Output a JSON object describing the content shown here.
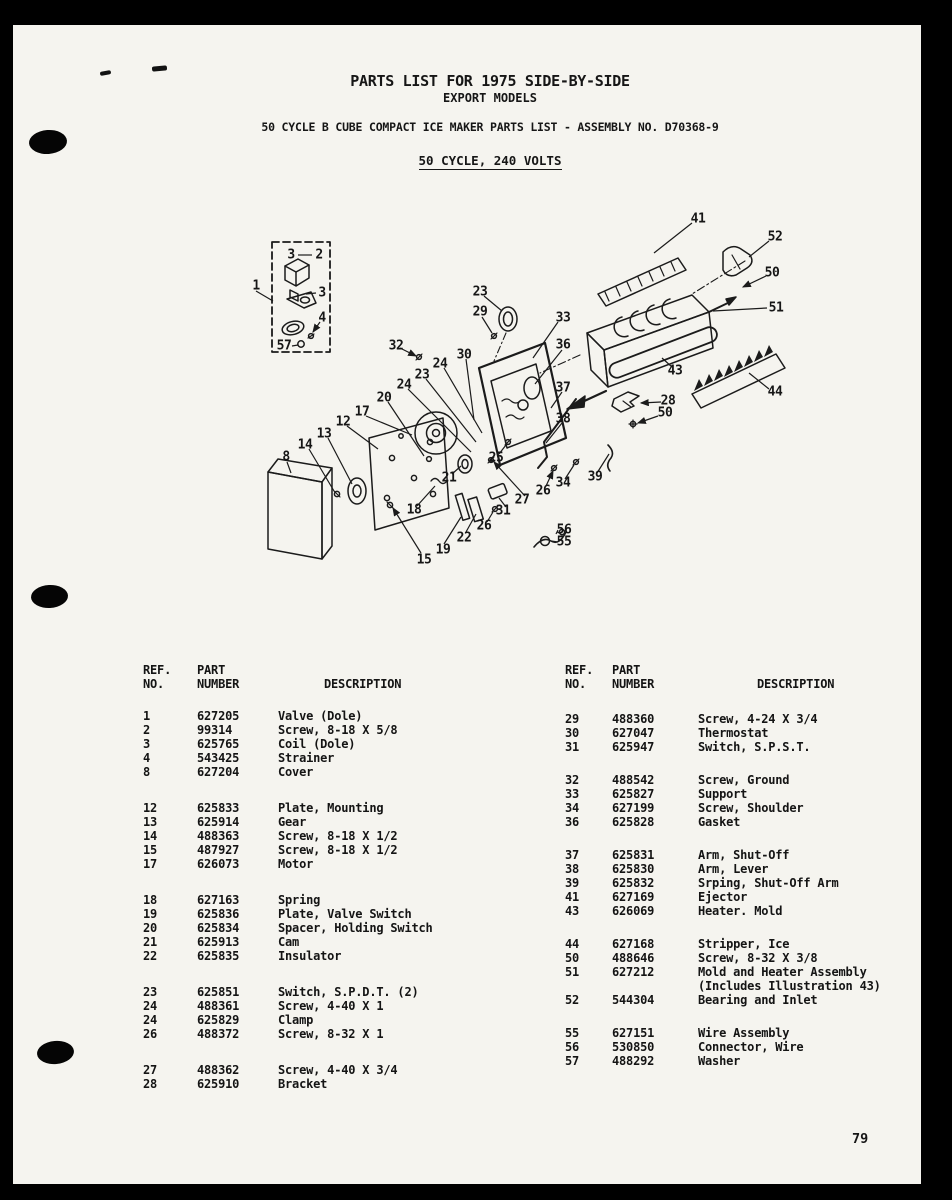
{
  "page": {
    "title_line1": "PARTS LIST FOR 1975 SIDE-BY-SIDE",
    "title_line2": "EXPORT MODELS",
    "subtitle": "50 CYCLE B CUBE COMPACT ICE MAKER PARTS LIST - ASSEMBLY NO. D70368-9",
    "voltage_line": "50 CYCLE, 240 VOLTS",
    "page_number": "79"
  },
  "colors": {
    "paper": "#f5f4ef",
    "ink": "#161616",
    "border": "#000000"
  },
  "parts_tables": {
    "headers": {
      "ref": "REF.",
      "no": "NO.",
      "part": "PART",
      "number": "NUMBER",
      "description": "DESCRIPTION"
    },
    "left": {
      "groups": [
        [
          [
            "1",
            "627205",
            "Valve (Dole)"
          ],
          [
            "2",
            "99314",
            "Screw, 8-18 X 5/8"
          ],
          [
            "3",
            "625765",
            "Coil (Dole)"
          ],
          [
            "4",
            "543425",
            "Strainer"
          ],
          [
            "8",
            "627204",
            "Cover"
          ]
        ],
        [
          [
            "12",
            "625833",
            "Plate, Mounting"
          ],
          [
            "13",
            "625914",
            "Gear"
          ],
          [
            "14",
            "488363",
            "Screw, 8-18 X 1/2"
          ],
          [
            "15",
            "487927",
            "Screw, 8-18 X 1/2"
          ],
          [
            "17",
            "626073",
            "Motor"
          ]
        ],
        [
          [
            "18",
            "627163",
            "Spring"
          ],
          [
            "19",
            "625836",
            "Plate, Valve Switch"
          ],
          [
            "20",
            "625834",
            "Spacer, Holding Switch"
          ],
          [
            "21",
            "625913",
            "Cam"
          ],
          [
            "22",
            "625835",
            "Insulator"
          ]
        ],
        [
          [
            "23",
            "625851",
            "Switch, S.P.D.T. (2)"
          ],
          [
            "24",
            "488361",
            "Screw, 4-40 X 1"
          ],
          [
            "24",
            "625829",
            "Clamp"
          ],
          [
            "26",
            "488372",
            "Screw, 8-32 X 1"
          ]
        ],
        [
          [
            "27",
            "488362",
            "Screw, 4-40 X 3/4"
          ],
          [
            "28",
            "625910",
            "Bracket"
          ]
        ]
      ]
    },
    "right": {
      "groups": [
        [
          [
            "29",
            "488360",
            "Screw, 4-24 X 3/4"
          ],
          [
            "30",
            "627047",
            "Thermostat"
          ],
          [
            "31",
            "625947",
            "Switch, S.P.S.T."
          ]
        ],
        [
          [
            "32",
            "488542",
            "Screw, Ground"
          ],
          [
            "33",
            "625827",
            "Support"
          ],
          [
            "34",
            "627199",
            "Screw, Shoulder"
          ],
          [
            "36",
            "625828",
            "Gasket"
          ]
        ],
        [
          [
            "37",
            "625831",
            "Arm, Shut-Off"
          ],
          [
            "38",
            "625830",
            "Arm, Lever"
          ],
          [
            "39",
            "625832",
            "Srping, Shut-Off Arm"
          ],
          [
            "41",
            "627169",
            "Ejector"
          ],
          [
            "43",
            "626069",
            "Heater. Mold"
          ]
        ],
        [
          [
            "44",
            "627168",
            "Stripper, Ice"
          ],
          [
            "50",
            "488646",
            "Screw, 8-32 X 3/8"
          ],
          [
            "51",
            "627212",
            "Mold and Heater Assembly",
            "(Includes Illustration 43)"
          ],
          [
            "52",
            "544304",
            "Bearing and Inlet"
          ]
        ],
        [
          [
            "55",
            "627151",
            "Wire Assembly"
          ],
          [
            "56",
            "530850",
            "Connector, Wire"
          ],
          [
            "57",
            "488292",
            "Washer"
          ]
        ]
      ]
    }
  },
  "diagram": {
    "callouts": [
      {
        "n": "1",
        "x": 16,
        "y": 91
      },
      {
        "n": "3",
        "x": 51,
        "y": 60
      },
      {
        "n": "2",
        "x": 79,
        "y": 60
      },
      {
        "n": "3",
        "x": 82,
        "y": 98
      },
      {
        "n": "4",
        "x": 82,
        "y": 123
      },
      {
        "n": "57",
        "x": 44,
        "y": 151
      },
      {
        "n": "8",
        "x": 46,
        "y": 262
      },
      {
        "n": "12",
        "x": 103,
        "y": 227
      },
      {
        "n": "13",
        "x": 84,
        "y": 239
      },
      {
        "n": "14",
        "x": 65,
        "y": 250
      },
      {
        "n": "15",
        "x": 184,
        "y": 365
      },
      {
        "n": "17",
        "x": 122,
        "y": 217
      },
      {
        "n": "18",
        "x": 174,
        "y": 315
      },
      {
        "n": "19",
        "x": 203,
        "y": 355
      },
      {
        "n": "20",
        "x": 144,
        "y": 203
      },
      {
        "n": "21",
        "x": 209,
        "y": 283
      },
      {
        "n": "22",
        "x": 224,
        "y": 343
      },
      {
        "n": "23",
        "x": 240,
        "y": 97
      },
      {
        "n": "23",
        "x": 182,
        "y": 180
      },
      {
        "n": "24",
        "x": 200,
        "y": 169
      },
      {
        "n": "24",
        "x": 164,
        "y": 190
      },
      {
        "n": "25",
        "x": 256,
        "y": 263
      },
      {
        "n": "26",
        "x": 303,
        "y": 296
      },
      {
        "n": "26",
        "x": 244,
        "y": 331
      },
      {
        "n": "27",
        "x": 282,
        "y": 305
      },
      {
        "n": "28",
        "x": 428,
        "y": 206
      },
      {
        "n": "29",
        "x": 240,
        "y": 117
      },
      {
        "n": "30",
        "x": 224,
        "y": 160
      },
      {
        "n": "31",
        "x": 263,
        "y": 316
      },
      {
        "n": "32",
        "x": 156,
        "y": 151
      },
      {
        "n": "33",
        "x": 323,
        "y": 123
      },
      {
        "n": "34",
        "x": 323,
        "y": 288
      },
      {
        "n": "36",
        "x": 323,
        "y": 150
      },
      {
        "n": "37",
        "x": 323,
        "y": 193
      },
      {
        "n": "38",
        "x": 323,
        "y": 224
      },
      {
        "n": "39",
        "x": 355,
        "y": 282
      },
      {
        "n": "41",
        "x": 458,
        "y": 24
      },
      {
        "n": "43",
        "x": 435,
        "y": 176
      },
      {
        "n": "44",
        "x": 535,
        "y": 197
      },
      {
        "n": "50",
        "x": 532,
        "y": 78
      },
      {
        "n": "50",
        "x": 425,
        "y": 218
      },
      {
        "n": "51",
        "x": 536,
        "y": 113
      },
      {
        "n": "52",
        "x": 535,
        "y": 42
      },
      {
        "n": "55",
        "x": 324,
        "y": 347
      },
      {
        "n": "56",
        "x": 324,
        "y": 335
      }
    ]
  }
}
